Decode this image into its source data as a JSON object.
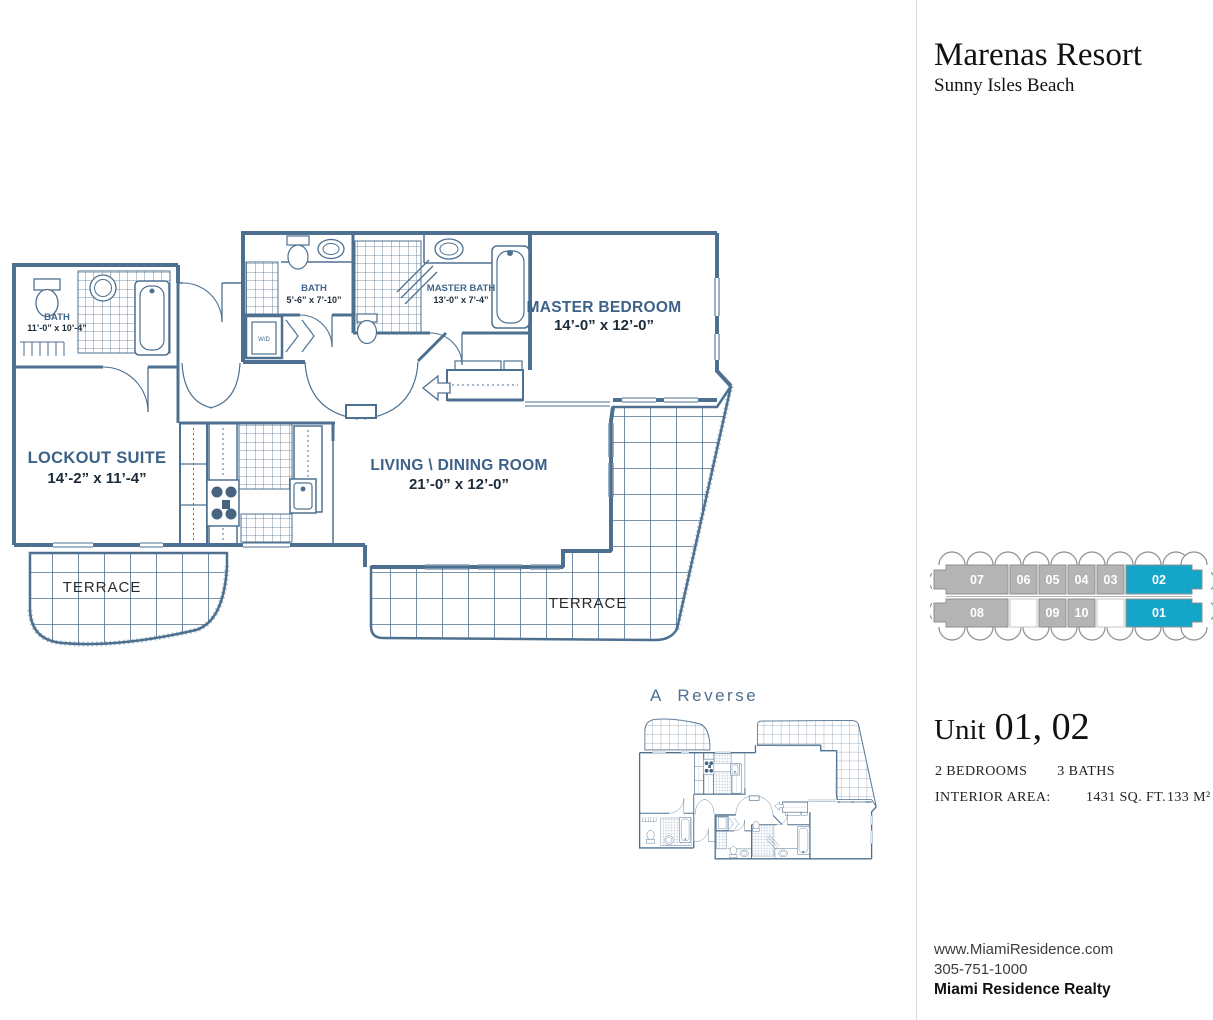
{
  "header": {
    "title": "Marenas Resort",
    "subtitle": "Sunny Isles Beach"
  },
  "plan": {
    "master_bedroom": "MASTER BEDROOM",
    "master_bedroom_dims": "14’-0” x 12’-0”",
    "living": "LIVING \\ DINING ROOM",
    "living_dims": "21’-0” x 12’-0”",
    "lockout": "LOCKOUT SUITE",
    "lockout_dims": "14’-2” x 11’-4”",
    "master_bath": "MASTER BATH",
    "master_bath_dims": "13’-0” x 7’-4”",
    "bath_a": "BATH",
    "bath_a_dims": "5’-6” x 7’-10”",
    "bath_b": "BATH",
    "bath_b_dims": "11’-0” x 10’-4”",
    "terrace_left": "TERRACE",
    "terrace_right": "TERRACE",
    "wd": "W/D",
    "reverse": "A  Reverse"
  },
  "keyplan": {
    "u01": "01",
    "u02": "02",
    "u03": "03",
    "u04": "04",
    "u05": "05",
    "u06": "06",
    "u07": "07",
    "u08": "08",
    "u09": "09",
    "u10": "10",
    "colors": {
      "gray": "#b4b4b4",
      "teal": "#14a5c9",
      "outline": "#8f8f8f"
    }
  },
  "unit": {
    "prefix": "Unit",
    "numbers": "01, 02"
  },
  "specs": {
    "bedrooms": "2 BEDROOMS",
    "baths": "3 BATHS",
    "area_label": "INTERIOR AREA:",
    "sqft": "1431 SQ. FT.",
    "m2": "133 M²"
  },
  "contact": {
    "website": "www.MiamiResidence.com",
    "phone": "305-751-1000",
    "company": "Miami Residence Realty"
  }
}
